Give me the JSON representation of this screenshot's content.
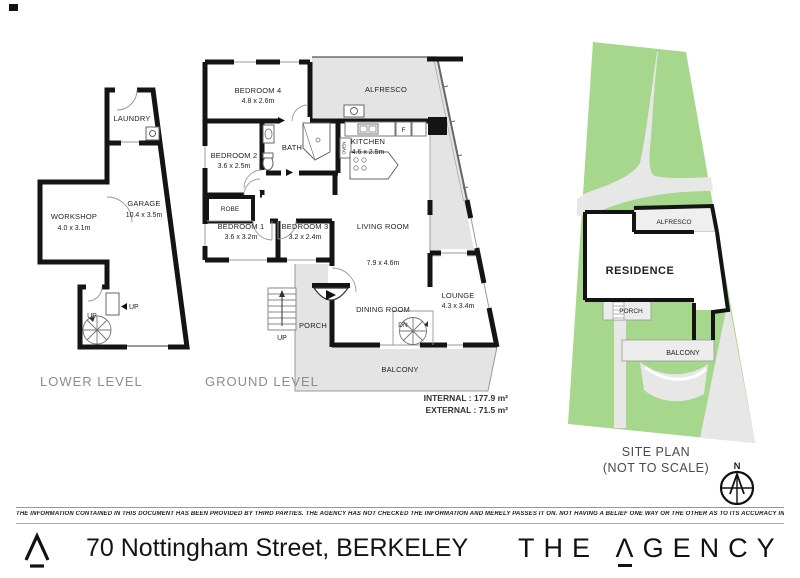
{
  "lower_level": {
    "label": "LOWER LEVEL",
    "laundry": "LAUNDRY",
    "workshop": {
      "name": "WORKSHOP",
      "dims": "4.0 x 3.1m"
    },
    "garage": {
      "name": "GARAGE",
      "dims": "10.4 x 3.5m"
    },
    "up_door": "UP",
    "up_stairs": "UP"
  },
  "ground_level": {
    "label": "GROUND LEVEL",
    "bedroom4": {
      "name": "BEDROOM 4",
      "dims": "4.8 x 2.6m"
    },
    "alfresco": "ALFRESCO",
    "bedroom2": {
      "name": "BEDROOM 2",
      "dims": "3.6 x 2.5m"
    },
    "bath": "BATH",
    "kitchen": {
      "name": "KITCHEN",
      "dims": "4.6 x 2.5m"
    },
    "fridge": "F",
    "oven": "OVEN",
    "robe": "ROBE",
    "bedroom1": {
      "name": "BEDROOM 1",
      "dims": "3.6 x 3.2m"
    },
    "bedroom3": {
      "name": "BEDROOM 3",
      "dims": "3.2 x 2.4m"
    },
    "living": {
      "name": "LIVING ROOM",
      "dims": "7.9 x 4.6m"
    },
    "lounge": {
      "name": "LOUNGE",
      "dims": "4.3 x 3.4m"
    },
    "dining": "DINING ROOM",
    "porch": "PORCH",
    "balcony": "BALCONY",
    "up": "UP",
    "dn": "DN",
    "internal": "INTERNAL : 177.9 m²",
    "external": "EXTERNAL : 71.5 m²"
  },
  "site_plan": {
    "title": "SITE PLAN",
    "subtitle": "(NOT TO SCALE)",
    "north": "N",
    "residence": "RESIDENCE",
    "alfresco": "ALFRESCO",
    "porch": "PORCH",
    "balcony": "BALCONY"
  },
  "footer": {
    "disclaimer": "THE INFORMATION CONTAINED IN THIS DOCUMENT HAS BEEN PROVIDED BY THIRD PARTIES. THE AGENCY HAS NOT CHECKED THE INFORMATION AND MERELY PASSES IT ON. NOT HAVING A BELIEF ONE WAY OR  THE OTHER AS TO ITS ACCURACY   INTERESTED PARTIES SHOULD MAKE AND RELY UPON THEIR OWN ENQUIRIES.",
    "address": "70 Nottingham Street, BERKELEY",
    "brand": {
      "the": "THE",
      "a": "Λ",
      "gency": "GENCY"
    }
  },
  "colors": {
    "wall": "#141414",
    "outdoor_gray": "#e4e4e4",
    "site_green": "#a7d68d",
    "drive_gray": "#e7e7e7"
  }
}
